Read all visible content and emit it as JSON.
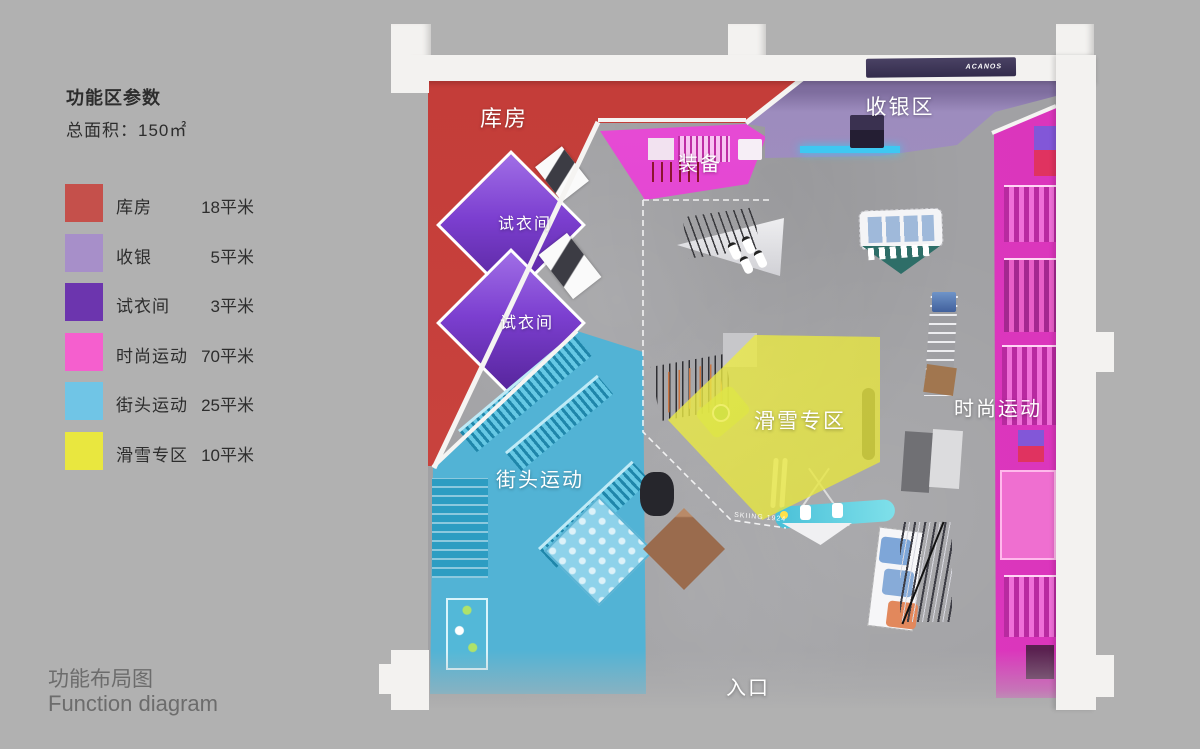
{
  "panel": {
    "title": "功能区参数",
    "total_area": "总面积：150㎡",
    "legend": [
      {
        "label": "库房",
        "area": "18平米",
        "color": "#c5504b"
      },
      {
        "label": "收银",
        "area": "5平米",
        "color": "#a78fc9"
      },
      {
        "label": "试衣间",
        "area": "3平米",
        "color": "#6c35ae"
      },
      {
        "label": "时尚运动",
        "area": "70平米",
        "color": "#f55fce"
      },
      {
        "label": "街头运动",
        "area": "25平米",
        "color": "#70c5e6"
      },
      {
        "label": "滑雪专区",
        "area": "10平米",
        "color": "#e9e73f"
      }
    ]
  },
  "footer": {
    "title_zh": "功能布局图",
    "title_en": "Function diagram"
  },
  "plan": {
    "zone_labels": {
      "storage": "库房",
      "equipment": "装备",
      "cashier": "收银区",
      "fitting_room_1": "试衣间",
      "fitting_room_2": "试衣间",
      "street_sports": "街头运动",
      "ski_zone": "滑雪专区",
      "fashion_sports": "时尚运动",
      "entrance": "入口"
    },
    "floor_note": "SKIING 1924",
    "sign_text": "ACANOS"
  }
}
